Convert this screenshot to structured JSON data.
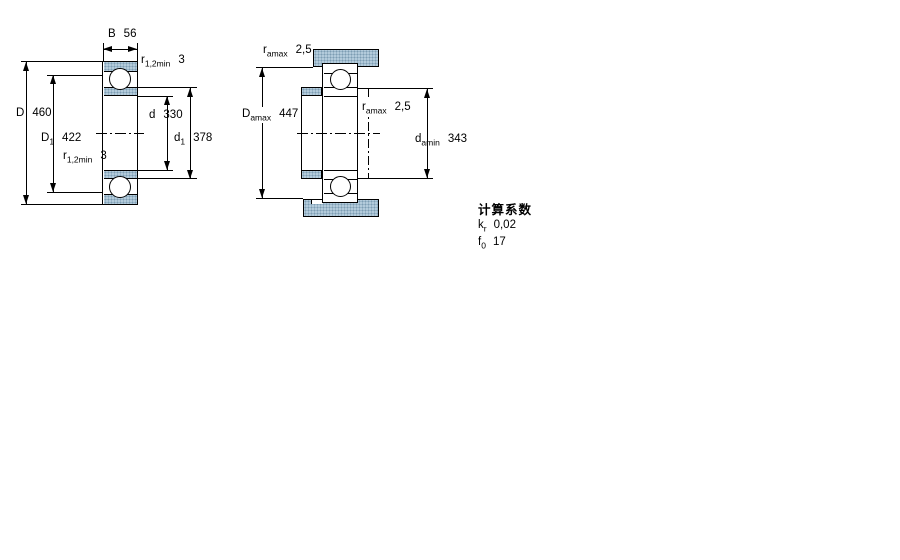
{
  "left_figure": {
    "dims": {
      "B": {
        "sym": "B",
        "sub": "",
        "value": "56"
      },
      "r12_top": {
        "sym": "r",
        "sub": "1,2min",
        "value": "3"
      },
      "D": {
        "sym": "D",
        "sub": "",
        "value": "460"
      },
      "D1": {
        "sym": "D",
        "sub": "1",
        "value": "422"
      },
      "r12_bot": {
        "sym": "r",
        "sub": "1,2min",
        "value": "3"
      },
      "d": {
        "sym": "d",
        "sub": "",
        "value": "330"
      },
      "d1": {
        "sym": "d",
        "sub": "1",
        "value": "378"
      }
    }
  },
  "right_figure": {
    "dims": {
      "ra_top": {
        "sym": "r",
        "sub": "amax",
        "value": "2,5"
      },
      "Da": {
        "sym": "D",
        "sub": "amax",
        "value": "447"
      },
      "ra_mid": {
        "sym": "r",
        "sub": "amax",
        "value": "2,5"
      },
      "da": {
        "sym": "d",
        "sub": "amin",
        "value": "343"
      }
    }
  },
  "factors": {
    "title": "计算系数",
    "rows": [
      {
        "sym": "k",
        "sub": "r",
        "value": "0,02"
      },
      {
        "sym": "f",
        "sub": "0",
        "value": "17"
      }
    ]
  },
  "colors": {
    "hatch_fill": "#b3cbdb",
    "hatch_dot": "#7d9db3",
    "line": "#000000",
    "background": "#ffffff"
  }
}
